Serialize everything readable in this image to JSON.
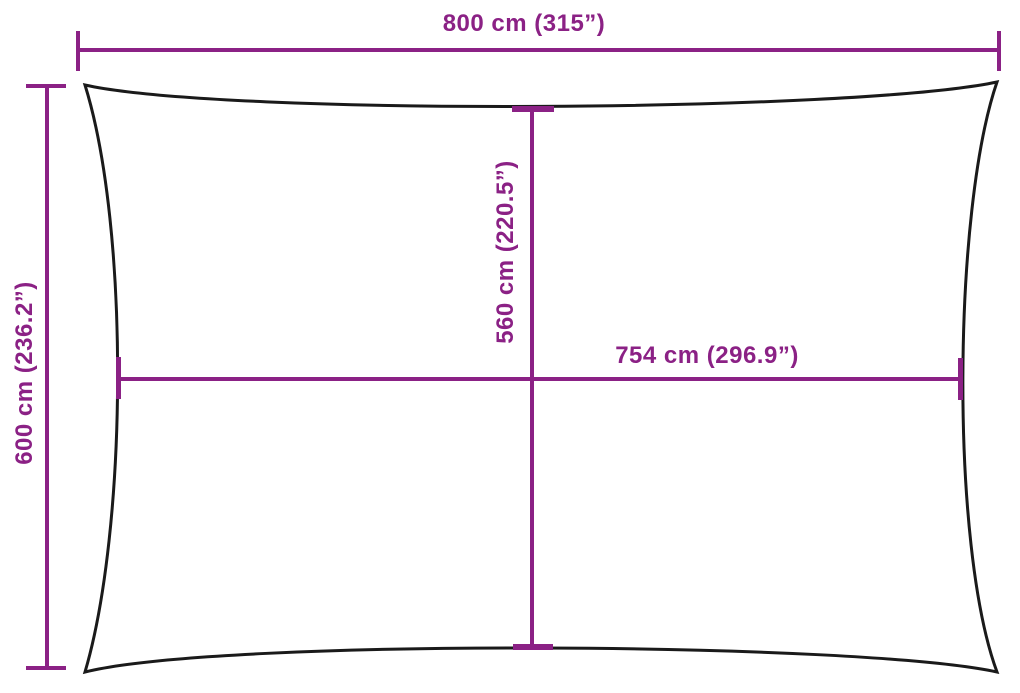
{
  "colors": {
    "background": "#ffffff",
    "outline": "#1a1a1a",
    "accent": "#8b2185"
  },
  "dimensions": {
    "top_width": {
      "label": "800 cm (315”)"
    },
    "left_height": {
      "label": "600 cm (236.2”)"
    },
    "center_height": {
      "label": "560 cm (220.5”)"
    },
    "center_width": {
      "label": "754 cm (296.9”)"
    }
  }
}
